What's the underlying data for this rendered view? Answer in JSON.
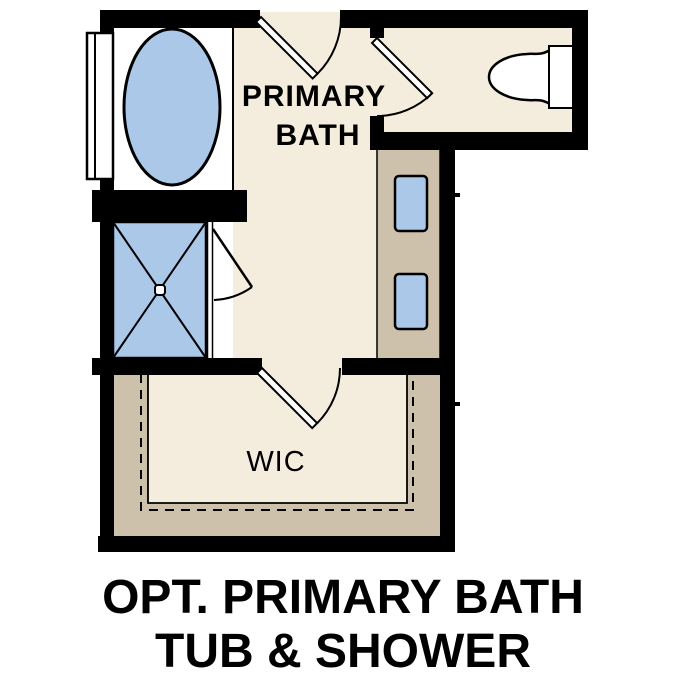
{
  "labels": {
    "primary_bath_line1": "PRIMARY",
    "primary_bath_line2": "BATH",
    "wic": "WIC",
    "caption_line1": "OPT. PRIMARY BATH",
    "caption_line2": "TUB & SHOWER"
  },
  "fixtures": {
    "bathtub": "oval-bathtub",
    "shower": "shower-pan-with-drain",
    "toilet": "toilet-with-tank",
    "vanity": "vanity-counter",
    "sinks": [
      "sink-basin-1",
      "sink-basin-2"
    ],
    "window": "window",
    "doors": [
      "primary-bath-door",
      "water-closet-door",
      "wic-door",
      "shower-door"
    ],
    "closet": "wic-shelving-with-rod"
  },
  "colors": {
    "wall": "#000000",
    "floor": "#f4edde",
    "fixture": "#abc8e9",
    "cabinet": "#cdc1ab",
    "tub_deck": "#ffffff",
    "line": "#000000"
  }
}
